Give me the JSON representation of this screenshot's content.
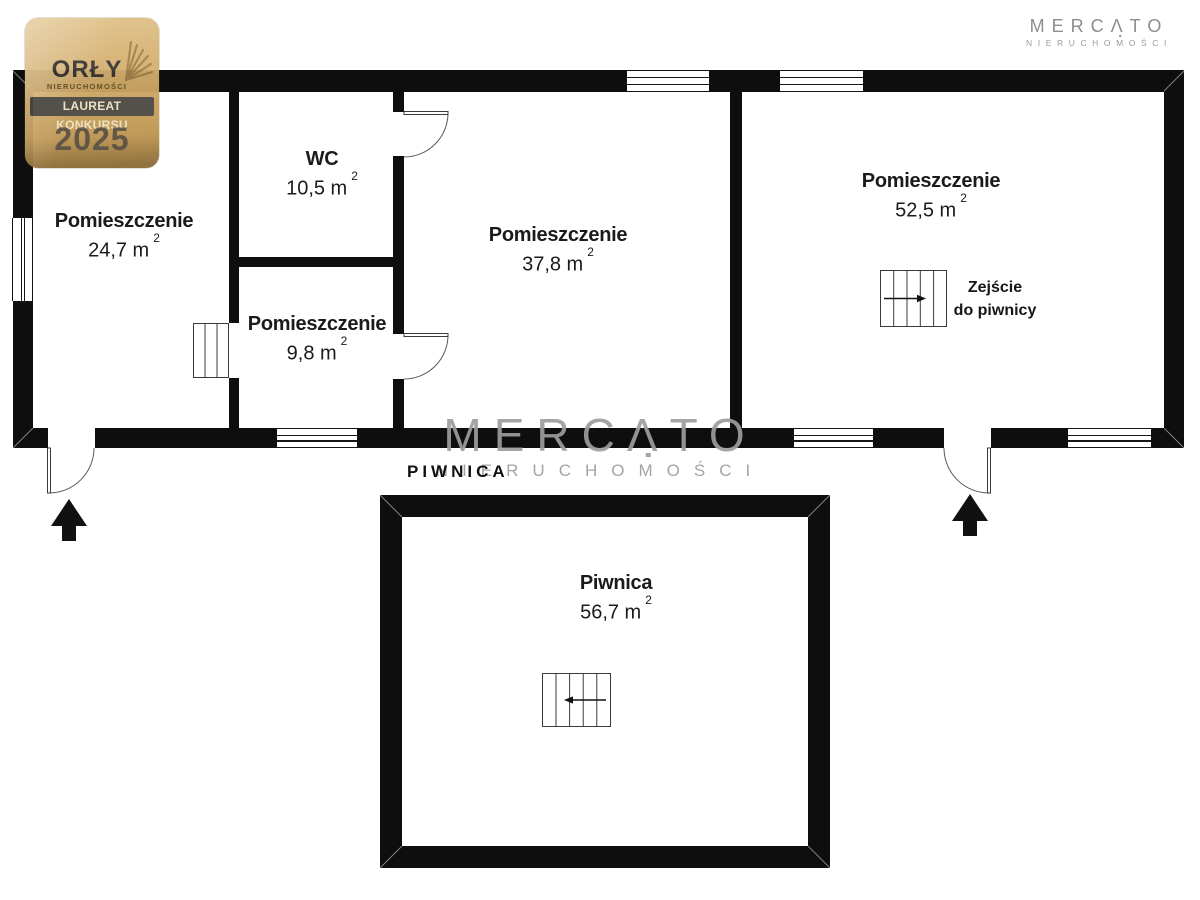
{
  "award_badge": {
    "title": "ORŁY",
    "subtitle": "NIERUCHOMOŚCI",
    "banner": "LAUREAT KONKURSU",
    "year": "2025"
  },
  "brand_logo": {
    "name": "MERCATO",
    "tagline": "NIERUCHOMOŚCI"
  },
  "watermark": {
    "name": "MERCATO",
    "tagline": "NIERUCHOMOŚCI"
  },
  "floor_section_label": "PIWNICA",
  "floorplan": {
    "rooms": [
      {
        "id": "room-24-7",
        "name": "Pomieszczenie",
        "area_value": "24,7 m",
        "area_sup": "2"
      },
      {
        "id": "wc",
        "name": "WC",
        "area_value": "10,5 m",
        "area_sup": "2"
      },
      {
        "id": "room-9-8",
        "name": "Pomieszczenie",
        "area_value": "9,8 m",
        "area_sup": "2"
      },
      {
        "id": "room-37-8",
        "name": "Pomieszczenie",
        "area_value": "37,8 m",
        "area_sup": "2"
      },
      {
        "id": "room-52-5",
        "name": "Pomieszczenie",
        "area_value": "52,5 m",
        "area_sup": "2"
      },
      {
        "id": "piwnica",
        "name": "Piwnica",
        "area_value": "56,7 m",
        "area_sup": "2"
      }
    ],
    "stairs_annotation": {
      "line1": "Zejście",
      "line2": "do piwnicy"
    }
  },
  "icons": {
    "eagle_wing": "feather-fan",
    "entrance_arrow": "solid up-arrow",
    "stairs": "tread-lines rectangle",
    "door_swing": "quarter-arc door"
  },
  "colors": {
    "wall": "#0e0e0e",
    "text": "#1b1b1b",
    "watermark_gray": "#9d9d9d",
    "logo_gray": "#8d8d8d",
    "badge_gold": "#c79f59",
    "badge_banner": "#4b4741",
    "badge_banner_text": "#ece1c3",
    "badge_text": "#3b3733"
  }
}
